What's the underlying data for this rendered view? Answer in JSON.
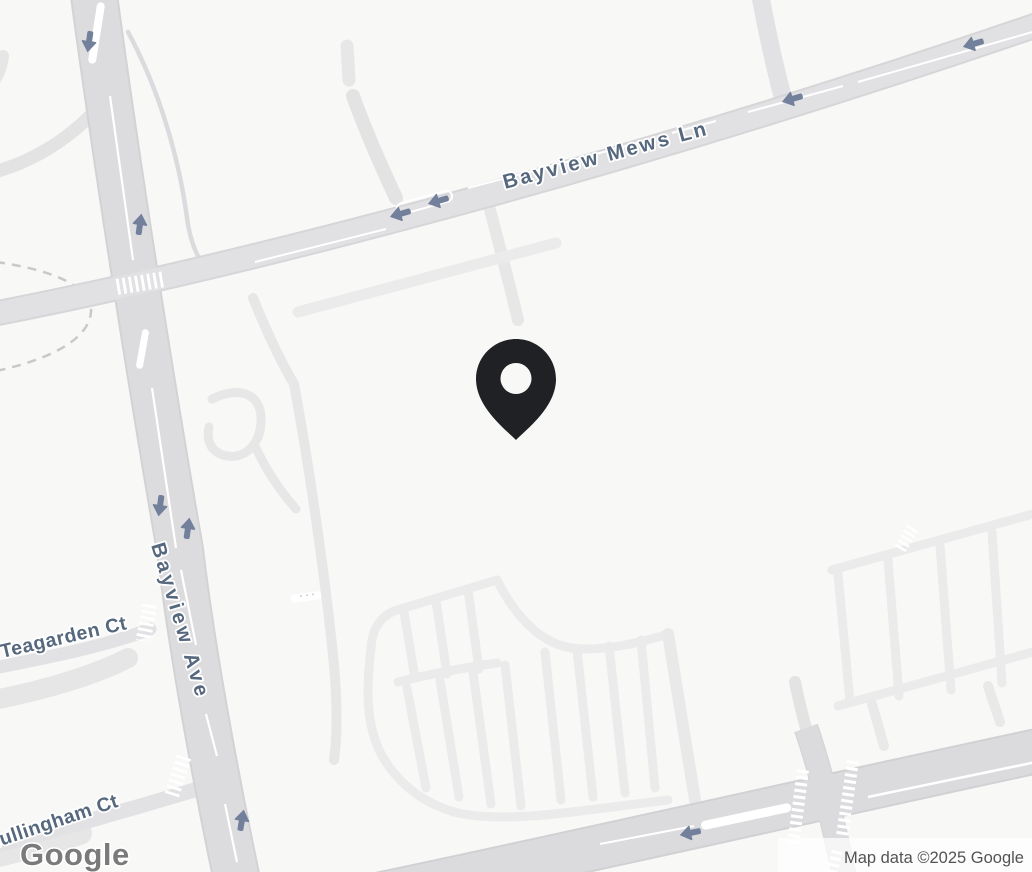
{
  "map": {
    "streets": {
      "bayview_mews_ln": "Bayview Mews Ln",
      "bayview_ave": "Bayview Ave",
      "teagarden_ct": "Teagarden Ct",
      "mullingham_ct": "Mullingham Ct"
    },
    "marker": {
      "name": "location-pin",
      "color": "#1f2124"
    },
    "one_way_arrows": {
      "count": 10,
      "color": "#72809c"
    },
    "colors": {
      "background": "#f8f8f7",
      "major_road": "#dcdcde",
      "minor_road": "#e3e3e4",
      "parking_lane": "#ebebec",
      "street_label": "#56687e"
    },
    "footer": {
      "logo": "Google",
      "attribution": "Map data ©2025 Google"
    }
  }
}
